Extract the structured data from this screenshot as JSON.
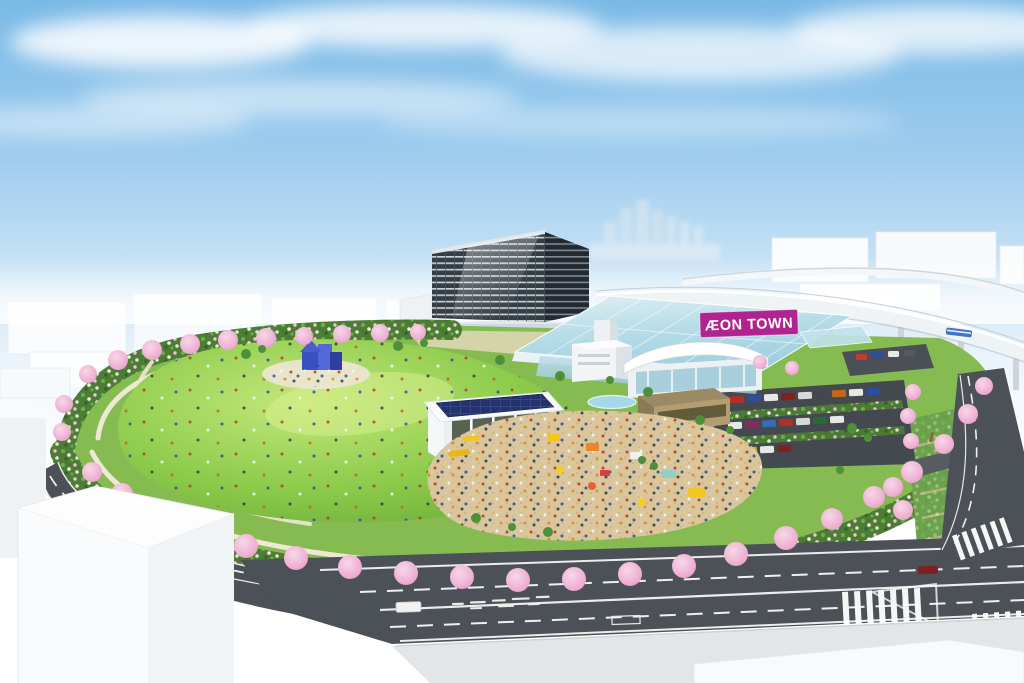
{
  "sign": {
    "label": "ÆON TOWN",
    "background": "#b02490",
    "text_color": "#ffffff"
  },
  "palette": {
    "sky_blue": "#79b9e6",
    "haze_white": "#ffffff",
    "glass_cyan": "#bfe2ea",
    "lawn_green": "#7cc244",
    "shrub_green": "#4d7c35",
    "sakura_pink": "#f0b8d8",
    "sand_plaza": "#d9c69c",
    "asphalt_gray": "#4b5156",
    "solar_panel_navy": "#24336b",
    "playground_blue": "#3a50c0",
    "tower_facade_dark": "#343c44",
    "train_blue": "#3f74c8"
  }
}
